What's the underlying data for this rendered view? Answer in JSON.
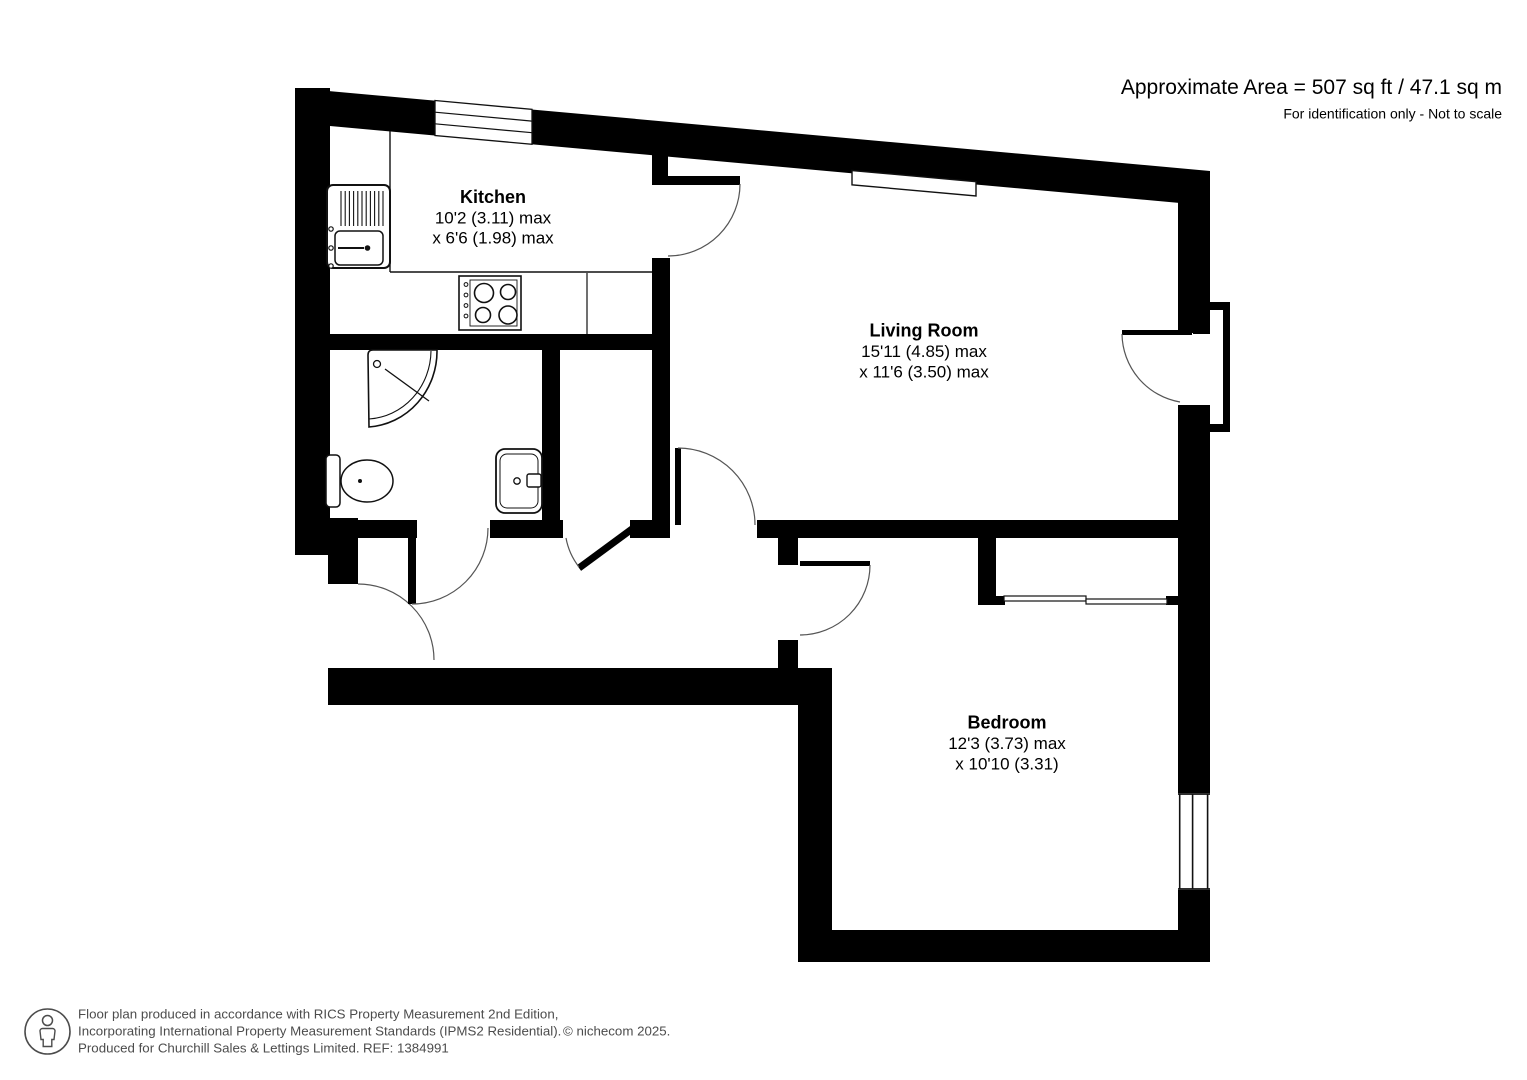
{
  "header": {
    "area": "Approximate Area = 507 sq ft / 47.1 sq m",
    "disclaimer": "For identification only - Not to scale"
  },
  "rooms": {
    "kitchen": {
      "name": "Kitchen",
      "dim_line1": "10'2 (3.11) max",
      "dim_line2": "x 6'6 (1.98) max"
    },
    "living_room": {
      "name": "Living Room",
      "dim_line1": "15'11 (4.85) max",
      "dim_line2": "x 11'6 (3.50) max"
    },
    "bedroom": {
      "name": "Bedroom",
      "dim_line1": "12'3 (3.73) max",
      "dim_line2": "x 10'10 (3.31)"
    }
  },
  "footer": {
    "line1": "Floor plan produced in accordance with RICS Property Measurement 2nd Edition,",
    "line2": "Incorporating International Property Measurement Standards (IPMS2 Residential).",
    "copyright": "© nichecom 2025.",
    "line3": "Produced for Churchill Sales & Lettings Limited.",
    "ref": "REF: 1384991"
  },
  "colors": {
    "wall": "#000000",
    "door_arc": "#555555",
    "footer_text": "#4c4c4c",
    "background": "#ffffff"
  }
}
